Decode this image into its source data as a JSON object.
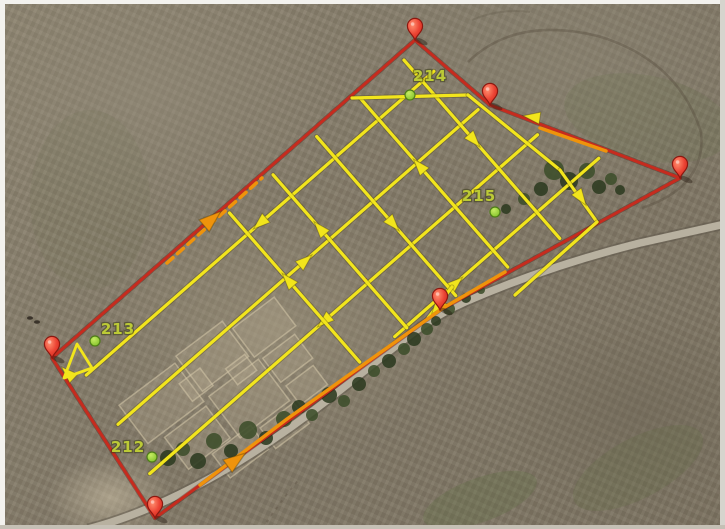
{
  "scene": {
    "description": "Aerial satellite map with UAV photogrammetry flight-plan overlay: red survey boundary with pushpins, yellow crosshatch flight lines with direction arrows, orange transit segments, numbered green waypoints",
    "canvas": {
      "width": 725,
      "height": 529
    }
  },
  "palette": {
    "boundary_red": "#c62b1e",
    "boundary_red_shadow": "rgba(70,12,6,0.35)",
    "route_orange": "#ef930b",
    "survey_yellow": "#f2e51c",
    "survey_yellow_shadow": "rgba(70,60,10,0.35)",
    "label_green": "#bcca36",
    "dot_green_edge": "#4e7d18",
    "pin_stroke": "#8c1810",
    "road_fill": "#b8b1a0",
    "road_edge": "rgba(96,90,76,0.55)",
    "tree_dark": "#2c3a20",
    "tree_mid": "#3c4d2a",
    "track_dark": "rgba(88,78,62,1)",
    "cropmark_fill": "rgba(198,184,156,0.22)",
    "cropmark_stroke": "rgba(214,200,170,0.55)",
    "tint_green": "95,110,66",
    "speck_dark": "#3a332a",
    "tiny_mark_red": "#cc2b1e"
  },
  "frame": {
    "top": "#f3f2ee",
    "left": "#f3f2ee",
    "right": "#d6d4cd",
    "bottom": "#c5c0b5"
  },
  "waypoints": [
    {
      "label": "212",
      "label_x": 128,
      "label_y": 452,
      "dot_x": 152,
      "dot_y": 457
    },
    {
      "label": "213",
      "label_x": 118,
      "label_y": 334,
      "dot_x": 95,
      "dot_y": 341
    },
    {
      "label": "214",
      "label_x": 430,
      "label_y": 81,
      "dot_x": 410,
      "dot_y": 95
    },
    {
      "label": "215",
      "label_x": 479,
      "label_y": 201,
      "dot_x": 495,
      "dot_y": 212
    }
  ],
  "boundary": {
    "vertices": [
      [
        415,
        40
      ],
      [
        490,
        105
      ],
      [
        680,
        178
      ],
      [
        440,
        310
      ],
      [
        155,
        518
      ],
      [
        52,
        358
      ]
    ],
    "pin_at_each_vertex": true
  },
  "route_orange": {
    "segments": [
      {
        "style": "dashed",
        "points": [
          [
            167,
            263
          ],
          [
            262,
            178
          ]
        ]
      },
      {
        "style": "solid",
        "points": [
          [
            540,
            128
          ],
          [
            606,
            151
          ]
        ]
      },
      {
        "style": "solid",
        "points": [
          [
            505,
            272
          ],
          [
            443,
            308
          ],
          [
            287,
            419
          ],
          [
            200,
            485
          ]
        ]
      }
    ],
    "arrows": [
      {
        "x": 212,
        "y": 219,
        "angle": -41
      },
      {
        "x": 236,
        "y": 460,
        "angle": -36
      }
    ]
  },
  "survey_grid": {
    "centroid": [
      372,
      251.5
    ],
    "dir_long": [
      0.753,
      -0.658
    ],
    "dir_cross": [
      0.658,
      0.753
    ],
    "offsets_long": [
      -95,
      -37,
      21,
      79
    ],
    "offsets_cross": [
      -150,
      -92,
      -34,
      24,
      82
    ],
    "inset_scale": 0.94,
    "arrows_long": [
      {
        "t": 0.5,
        "dir": -1
      },
      {
        "t": 0.52,
        "dir": 1
      },
      {
        "t": 0.45,
        "dir": -1
      },
      {
        "t": 0.3,
        "dir": 1
      }
    ],
    "arrows_cross": [
      {
        "t": 0.45,
        "dir": 1
      },
      {
        "t": 0.4,
        "dir": -1
      },
      {
        "t": 0.55,
        "dir": 1
      },
      {
        "t": 0.35,
        "dir": -1
      },
      {
        "t": 0.45,
        "dir": -1
      }
    ],
    "extras": [
      {
        "points": [
          [
            352,
            98
          ],
          [
            468,
            95
          ],
          [
            560,
            170
          ]
        ]
      },
      {
        "points": [
          [
            560,
            170
          ],
          [
            597,
            222
          ],
          [
            515,
            295
          ]
        ]
      },
      {
        "points": [
          [
            452,
            287
          ],
          [
            428,
            318
          ]
        ]
      }
    ],
    "extra_arrows": [
      {
        "x": 532,
        "y": 117,
        "angle": 188
      },
      {
        "x": 581,
        "y": 198,
        "angle": 55
      },
      {
        "x": 437,
        "y": 307,
        "angle": 127
      },
      {
        "x": 68,
        "y": 373,
        "angle": 223
      }
    ],
    "start_triangle": [
      [
        77,
        344
      ],
      [
        64,
        378
      ],
      [
        92,
        368
      ]
    ]
  },
  "terrain": {
    "road_path": "M 88 529 C 160 510 240 468 330 398 C 400 344 420 322 465 302 C 520 278 580 258 640 243 C 680 234 712 227 725 224",
    "trees": [
      [
        168,
        458,
        8
      ],
      [
        183,
        449,
        7
      ],
      [
        198,
        461,
        8
      ],
      [
        214,
        441,
        8
      ],
      [
        231,
        451,
        7
      ],
      [
        248,
        430,
        9
      ],
      [
        266,
        438,
        7
      ],
      [
        284,
        419,
        8
      ],
      [
        299,
        407,
        7
      ],
      [
        312,
        415,
        6
      ],
      [
        329,
        395,
        8
      ],
      [
        344,
        401,
        6
      ],
      [
        359,
        384,
        7
      ],
      [
        374,
        371,
        6
      ],
      [
        389,
        361,
        7
      ],
      [
        404,
        349,
        6
      ],
      [
        414,
        339,
        7
      ],
      [
        427,
        329,
        6
      ],
      [
        436,
        321,
        5
      ],
      [
        449,
        309,
        6
      ],
      [
        466,
        298,
        5
      ],
      [
        481,
        290,
        4
      ],
      [
        541,
        189,
        7
      ],
      [
        524,
        199,
        6
      ],
      [
        506,
        209,
        5
      ],
      [
        554,
        170,
        10
      ],
      [
        569,
        181,
        9
      ],
      [
        587,
        171,
        8
      ],
      [
        599,
        187,
        7
      ],
      [
        611,
        179,
        6
      ],
      [
        620,
        190,
        5
      ]
    ],
    "tracks": [
      {
        "d": "M 468 62 Q 515 16 598 36 Q 678 60 701 132 Q 707 186 642 208",
        "w": 2.5,
        "o": 0.4,
        "dash": ""
      },
      {
        "d": "M 262 529 Q 280 502 300 478",
        "w": 2,
        "o": 0.35,
        "dash": "3 5"
      },
      {
        "d": "M 472 20 Q 500 8 530 12",
        "w": 2,
        "o": 0.25,
        "dash": ""
      }
    ],
    "cropmark_center": [
      228,
      392
    ],
    "cropmark_rotation": -37,
    "cropmarks": [
      [
        -95,
        -55,
        70,
        48
      ],
      [
        -20,
        -60,
        58,
        44
      ],
      [
        42,
        -48,
        52,
        36
      ],
      [
        -78,
        -2,
        52,
        40
      ],
      [
        -18,
        -8,
        62,
        52
      ],
      [
        48,
        -6,
        40,
        30
      ],
      [
        -50,
        40,
        48,
        30
      ],
      [
        4,
        48,
        42,
        26
      ],
      [
        50,
        30,
        34,
        24
      ],
      [
        -34,
        -36,
        26,
        22
      ],
      [
        12,
        -20,
        24,
        20
      ]
    ],
    "tints": [
      {
        "x": 480,
        "y": 500,
        "rx": 60,
        "ry": 22,
        "rot": -20,
        "o": 0.28
      },
      {
        "x": 638,
        "y": 468,
        "rx": 72,
        "ry": 30,
        "rot": -28,
        "o": 0.22
      },
      {
        "x": 648,
        "y": 118,
        "rx": 85,
        "ry": 42,
        "rot": 12,
        "o": 0.14
      },
      {
        "x": 90,
        "y": 200,
        "rx": 60,
        "ry": 90,
        "rot": 0,
        "o": 0.1
      }
    ],
    "specks": [
      [
        30,
        318
      ],
      [
        37,
        322
      ]
    ],
    "tiny_red_mark": {
      "x": 363,
      "y": 278
    }
  }
}
